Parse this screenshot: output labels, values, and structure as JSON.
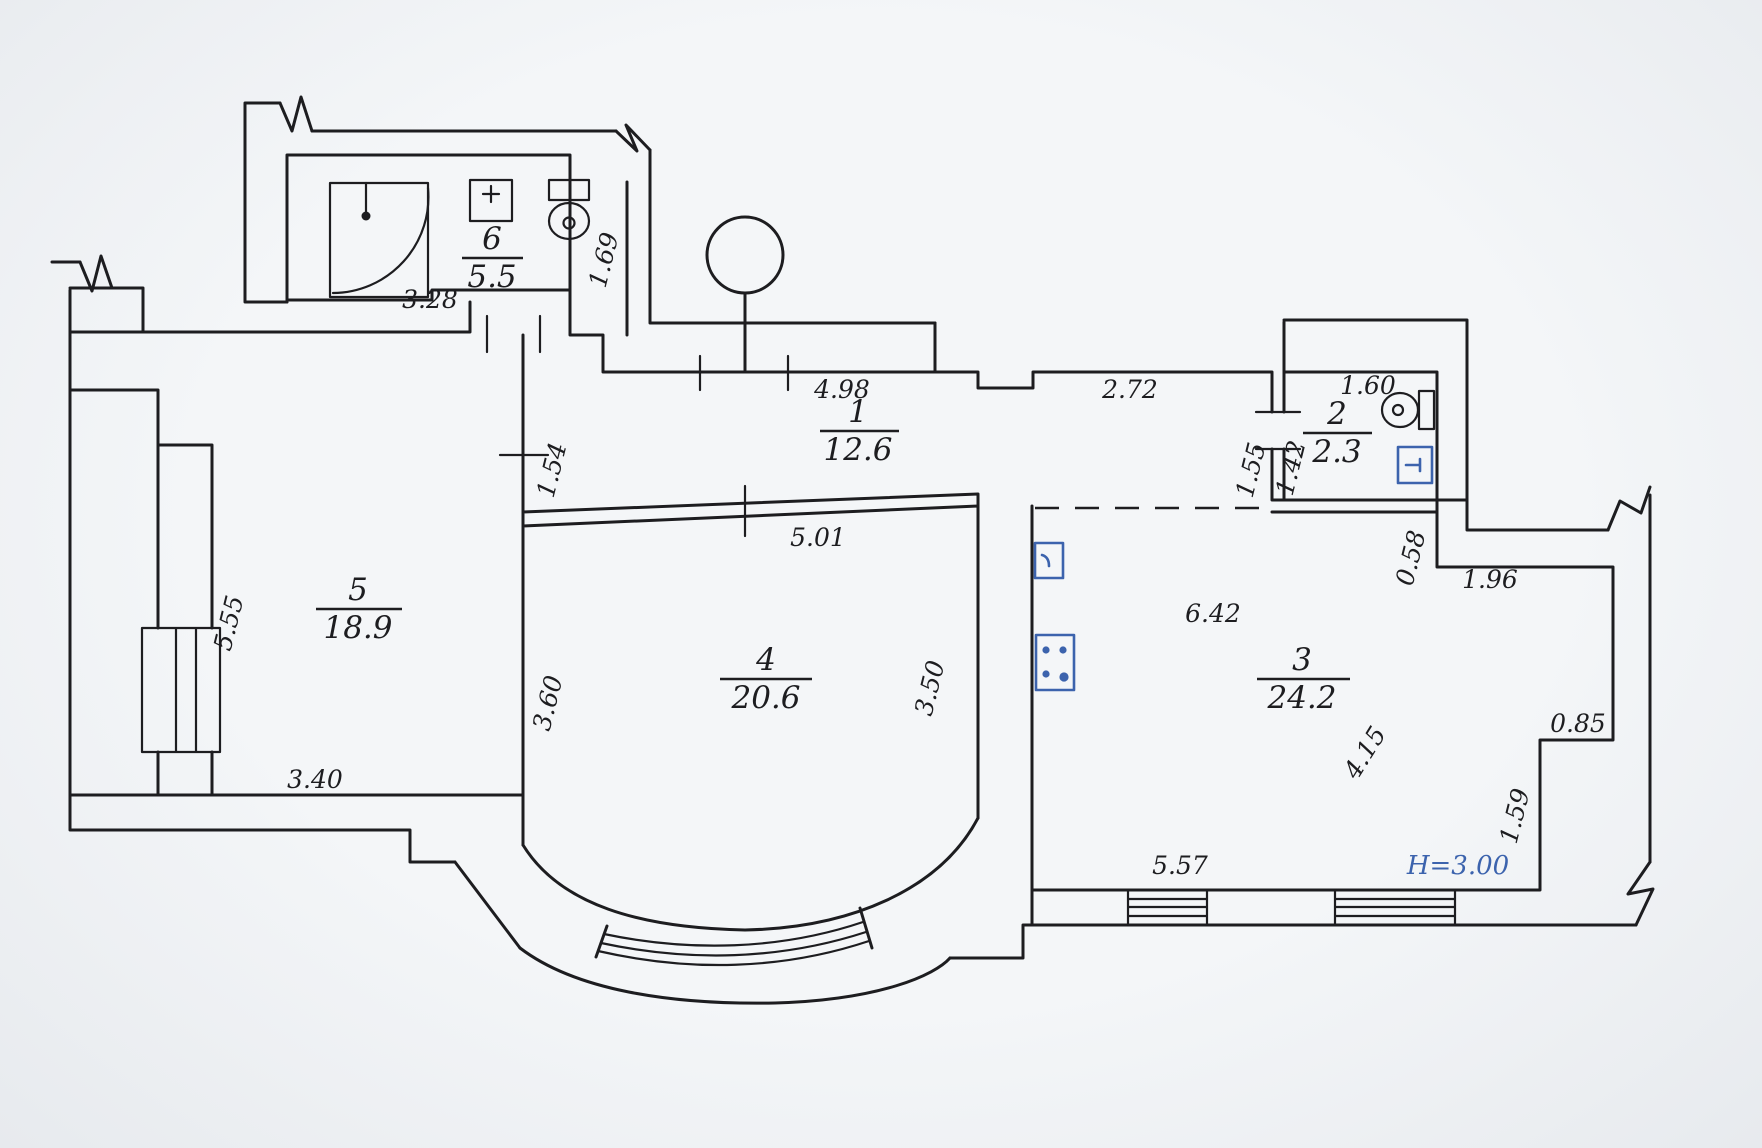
{
  "plan": {
    "title": "hand-drawn apartment floor plan",
    "rooms": [
      {
        "number": "6",
        "area": "5.5"
      },
      {
        "number": "1",
        "area": "12.6"
      },
      {
        "number": "2",
        "area": "2.3"
      },
      {
        "number": "3",
        "area": "24.2"
      },
      {
        "number": "4",
        "area": "20.6"
      },
      {
        "number": "5",
        "area": "18.9"
      }
    ],
    "dims": {
      "w328": "3.28",
      "h169": "1.69",
      "w498": "4.98",
      "w272": "2.72",
      "w160": "1.60",
      "h155": "1.55",
      "h142": "1.42",
      "w501": "5.01",
      "h154": "1.54",
      "h555": "5.55",
      "h360": "3.60",
      "h350": "3.50",
      "w642": "6.42",
      "d415": "4.15",
      "h058": "0.58",
      "w196": "1.96",
      "w085": "0.85",
      "h159": "1.59",
      "w340": "3.40",
      "w557": "5.57"
    },
    "notes": {
      "ceiling_height": "H=3.00"
    },
    "colors": {
      "ink": "#1d1d20",
      "accent": "#3c63ad",
      "paper": "#eff1f4"
    },
    "fixtures": [
      "shower",
      "washbasin",
      "toilet-bathroom",
      "toilet-wc",
      "water-heater",
      "kitchen-sink",
      "stove",
      "column",
      "bay-window",
      "windows"
    ]
  }
}
